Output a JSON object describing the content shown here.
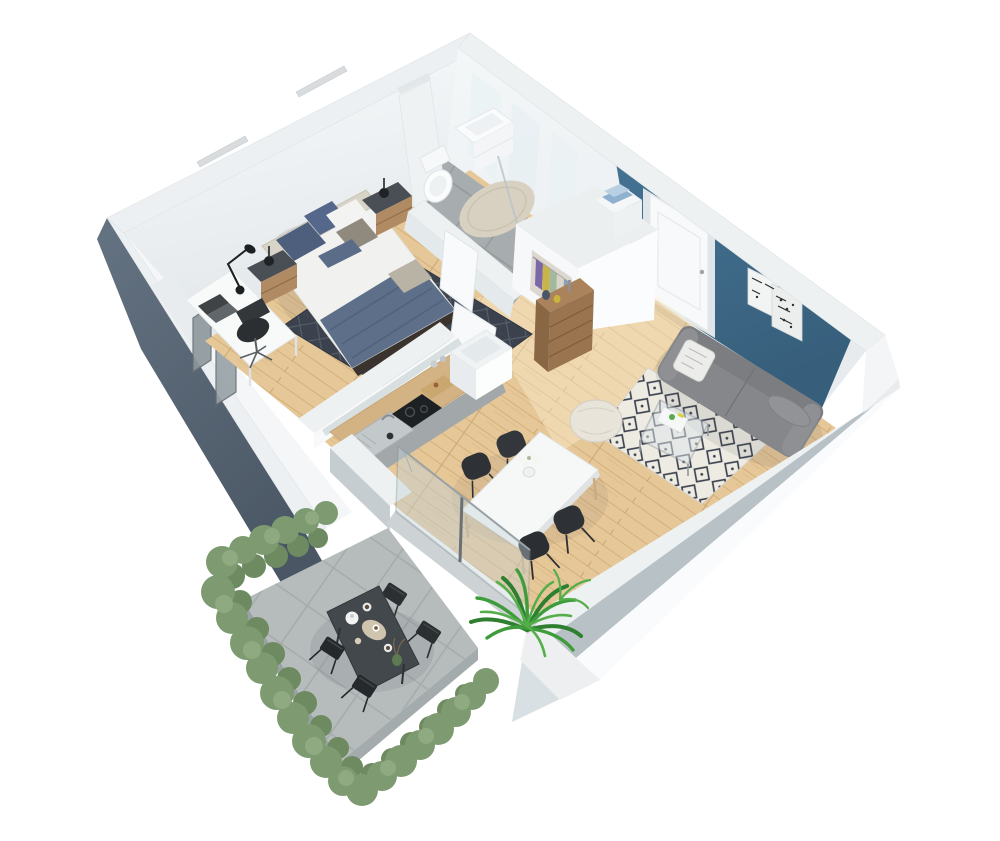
{
  "scene": {
    "title": "3D isometric cutaway floor plan of a studio apartment with terrace",
    "type": "architectural-3d-floorplan-render",
    "background": "#ffffff",
    "palette": {
      "accent_wall_teal": "#3e6f8e",
      "exterior_wall_slate": "#566475",
      "wall_white": "#eef1f2",
      "wood_floor": "#e6c798",
      "bathroom_tile": "#a6abad",
      "bedroom_rug": "#3b424d",
      "living_rug_base": "#edebe2",
      "living_rug_pattern": "#3d4250",
      "sofa_grey": "#85878a",
      "hedge_green": "#7d9a70",
      "palm_green": "#3f9c3b",
      "counter_wood": "#d3b383",
      "dresser_wood": "#9a744e",
      "balcony_floor": "#b6bcbc",
      "outdoor_furniture": "#43484c",
      "bedding_blue": "#5e7089"
    },
    "rooms": [
      {
        "name": "Bedroom",
        "furniture": [
          "double bed with white duvet and blue-grey throw",
          "beige upholstered headboard",
          "blue and grey cushions",
          "two nightstands with black ball lamps",
          "dark charcoal patterned rug",
          "white desk with laptop",
          "black articulated desk lamp",
          "black swivel office chair",
          "two windows in west wall"
        ]
      },
      {
        "name": "Bathroom",
        "furniture": [
          "toilet",
          "white vanity unit with basin",
          "glass shower screen",
          "round beige bath mat",
          "grey tile floor",
          "tall white storage column"
        ]
      },
      {
        "name": "Hallway",
        "furniture": [
          "open wardrobe with hanging clothes",
          "shelf unit with folded blue towels",
          "two open white doors"
        ]
      },
      {
        "name": "Entrance",
        "furniture": [
          "white entry door on teal accent wall",
          "wooden chest of drawers",
          "decorative vases and figurine"
        ]
      },
      {
        "name": "Living room",
        "furniture": [
          "grey fabric sofa with white patterned cushion and bolster",
          "glass coffee table with magazine",
          "cream knitted pouf",
          "black and white geometric rug",
          "two monochrome posters on teal wall"
        ]
      },
      {
        "name": "Kitchen",
        "furniture": [
          "oak worktop",
          "stainless steel sink with drainer",
          "black cooktop",
          "grey cabinet fronts",
          "glass splashback",
          "white island end unit",
          "storage jars and serving board"
        ]
      },
      {
        "name": "Dining area",
        "furniture": [
          "white rectangular dining table with wood legs",
          "four black shell chairs",
          "vase with white flowers",
          "potted palm plant by the window"
        ]
      },
      {
        "name": "Balcony",
        "furniture": [
          "dark grey outdoor dining table",
          "four black folding chairs",
          "teapot, cups and tray",
          "green perimeter hedges",
          "concrete tile floor",
          "sliding glass doors"
        ]
      }
    ]
  }
}
